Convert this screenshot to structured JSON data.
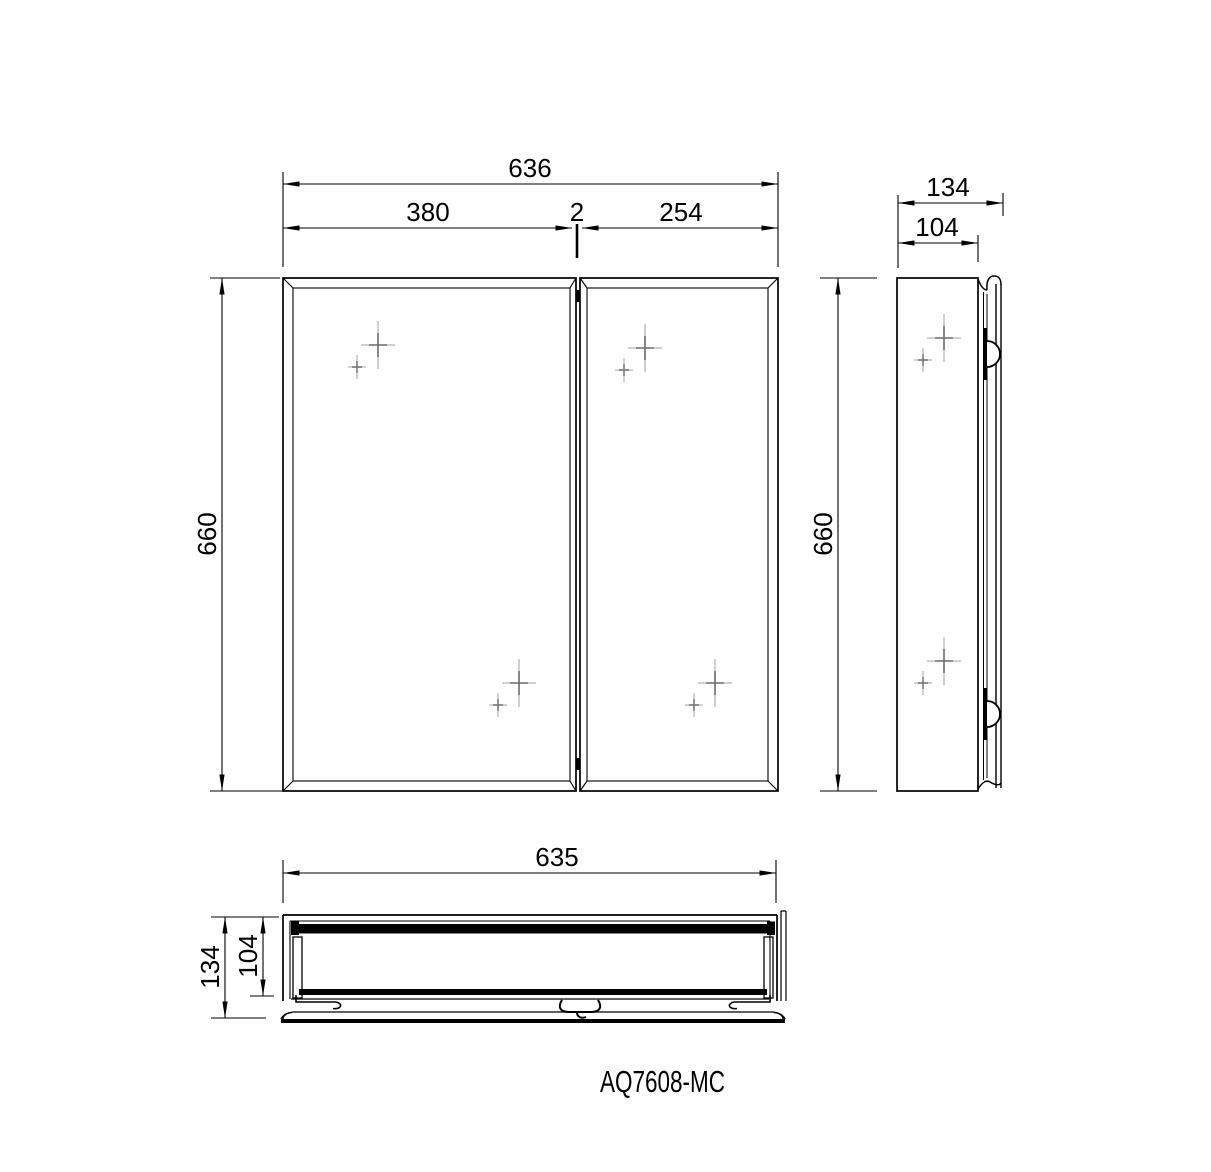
{
  "page": {
    "background": "#ffffff",
    "line_color": "#000000"
  },
  "drawing": {
    "model_label": "AQ7608-MC",
    "front_view": {
      "width_total": "636",
      "door_left_width": "380",
      "door_gap": "2",
      "door_right_width": "254",
      "height": "660"
    },
    "side_view": {
      "depth_total": "134",
      "depth_body": "104",
      "height": "660"
    },
    "plan_view": {
      "width": "635",
      "depth_total": "134",
      "depth_body": "104"
    }
  }
}
